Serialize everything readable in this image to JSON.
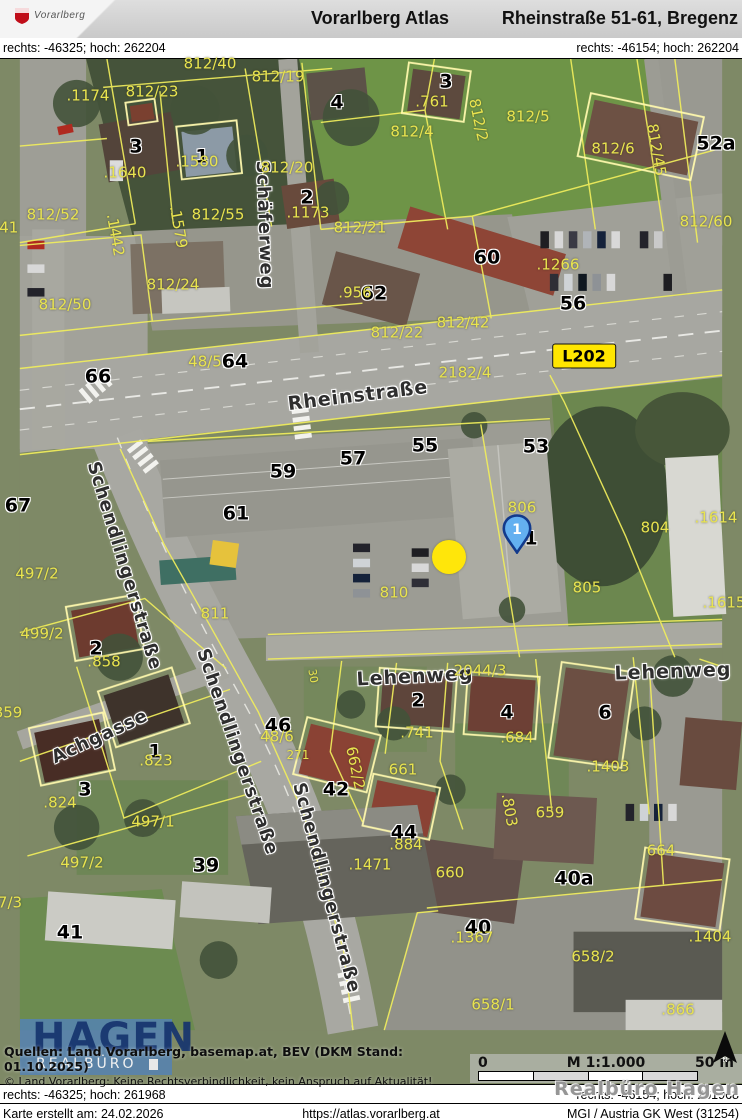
{
  "header": {
    "logo_text": "Vorarlberg",
    "app_title": "Vorarlberg Atlas",
    "page_title": "Rheinstraße 51-61, Bregenz"
  },
  "coords": {
    "top_left": "rechts: -46325; hoch: 262204",
    "top_right": "rechts: -46154; hoch: 262204",
    "bottom_left": "rechts: -46325; hoch: 261968",
    "bottom_right": "rechts: -46154; hoch: 261968"
  },
  "footer": {
    "created": "Karte erstellt am: 24.02.2026",
    "url": "https://atlas.vorarlberg.at",
    "crs": "MGI / Austria GK West (31254)"
  },
  "sources": {
    "line1": "Quellen: Land Vorarlberg, basemap.at, BEV (DKM Stand: 01.10.2025)",
    "line2": "© Land Vorarlberg: Keine Rechtsverbindlichkeit, kein Anspruch auf Aktualität!"
  },
  "scalebar": {
    "left": "0",
    "center": "M 1:1.000",
    "right": "50 m"
  },
  "watermark": "Realbüro Hagen",
  "logo_overlay": {
    "line1": "HAGEN",
    "line2": "REALBÜRO"
  },
  "markers": {
    "pin": {
      "x": 517,
      "y": 548,
      "label": "1"
    },
    "dot": {
      "x": 449,
      "y": 557
    },
    "road_badge": {
      "x": 584,
      "y": 356,
      "label": "L202"
    }
  },
  "colors": {
    "badge_bg": "#ffe600",
    "pin_fill": "#64b0f0",
    "pin_border": "#123a8c",
    "dot_fill": "#ffe60a",
    "parcel_text": "#e9e44f",
    "cadastral_line": "#f1ee5c",
    "logo_blue": "rgba(82,130,184,0.8)"
  },
  "map_labels": {
    "streets": [
      {
        "t": "Schäferweg",
        "x": 264,
        "y": 225,
        "r": 88
      },
      {
        "t": "Rheinstraße",
        "x": 358,
        "y": 396,
        "r": -7,
        "s": 19
      },
      {
        "t": "Schendlingerstraße",
        "x": 124,
        "y": 566,
        "r": 73
      },
      {
        "t": "Schendlingerstraße",
        "x": 237,
        "y": 752,
        "r": 71
      },
      {
        "t": "Schendlingerstraße",
        "x": 326,
        "y": 888,
        "r": 75
      },
      {
        "t": "Achgasse",
        "x": 100,
        "y": 737,
        "r": -25
      },
      {
        "t": "Lehenweg",
        "x": 415,
        "y": 677,
        "r": -3,
        "s": 19
      },
      {
        "t": "Lehenweg",
        "x": 673,
        "y": 672,
        "r": -2,
        "s": 19
      }
    ],
    "houses": [
      {
        "t": "4",
        "x": 337,
        "y": 103
      },
      {
        "t": "3",
        "x": 136,
        "y": 147
      },
      {
        "t": "1",
        "x": 202,
        "y": 157
      },
      {
        "t": "2",
        "x": 307,
        "y": 198
      },
      {
        "t": "3",
        "x": 446,
        "y": 82
      },
      {
        "t": "52a",
        "x": 716,
        "y": 144
      },
      {
        "t": "64",
        "x": 235,
        "y": 362
      },
      {
        "t": "66",
        "x": 98,
        "y": 377
      },
      {
        "t": "60",
        "x": 487,
        "y": 258
      },
      {
        "t": "62",
        "x": 374,
        "y": 294
      },
      {
        "t": "56",
        "x": 573,
        "y": 304
      },
      {
        "t": "67",
        "x": 18,
        "y": 506
      },
      {
        "t": "59",
        "x": 283,
        "y": 472
      },
      {
        "t": "57",
        "x": 353,
        "y": 459
      },
      {
        "t": "55",
        "x": 425,
        "y": 446
      },
      {
        "t": "53",
        "x": 536,
        "y": 447
      },
      {
        "t": "61",
        "x": 236,
        "y": 514
      },
      {
        "t": "1",
        "x": 531,
        "y": 539
      },
      {
        "t": "46",
        "x": 278,
        "y": 726
      },
      {
        "t": "2",
        "x": 418,
        "y": 701
      },
      {
        "t": "4",
        "x": 507,
        "y": 713
      },
      {
        "t": "6",
        "x": 605,
        "y": 713
      },
      {
        "t": "42",
        "x": 336,
        "y": 790
      },
      {
        "t": "44",
        "x": 404,
        "y": 833
      },
      {
        "t": "1",
        "x": 155,
        "y": 752
      },
      {
        "t": "3",
        "x": 85,
        "y": 790
      },
      {
        "t": "39",
        "x": 206,
        "y": 866
      },
      {
        "t": "41",
        "x": 70,
        "y": 933
      },
      {
        "t": "40",
        "x": 478,
        "y": 928
      },
      {
        "t": "40a",
        "x": 574,
        "y": 879
      },
      {
        "t": "2",
        "x": 96,
        "y": 649
      }
    ],
    "parcels": [
      {
        "t": "812/40",
        "x": 210,
        "y": 64
      },
      {
        "t": ".1174",
        "x": 88,
        "y": 96
      },
      {
        "t": "812/23",
        "x": 152,
        "y": 92
      },
      {
        "t": "812/19",
        "x": 278,
        "y": 77
      },
      {
        "t": ".761",
        "x": 432,
        "y": 102
      },
      {
        "t": "812/4",
        "x": 412,
        "y": 132
      },
      {
        "t": "812/2",
        "x": 478,
        "y": 120,
        "r": 78
      },
      {
        "t": "812/5",
        "x": 528,
        "y": 117
      },
      {
        "t": "812/6",
        "x": 613,
        "y": 149
      },
      {
        "t": "812/45",
        "x": 656,
        "y": 150,
        "r": 80
      },
      {
        "t": "812/60",
        "x": 706,
        "y": 222
      },
      {
        "t": ".1640",
        "x": 125,
        "y": 173
      },
      {
        "t": ".1580",
        "x": 197,
        "y": 162
      },
      {
        "t": "812/20",
        "x": 287,
        "y": 168
      },
      {
        "t": ".1173",
        "x": 308,
        "y": 213
      },
      {
        "t": "812/52",
        "x": 53,
        "y": 215
      },
      {
        "t": ".1442",
        "x": 115,
        "y": 235,
        "r": 80
      },
      {
        "t": ".1579",
        "x": 178,
        "y": 227,
        "r": 80
      },
      {
        "t": "812/55",
        "x": 218,
        "y": 215
      },
      {
        "t": "441",
        "x": 4,
        "y": 228
      },
      {
        "t": "812/50",
        "x": 65,
        "y": 305
      },
      {
        "t": "812/24",
        "x": 173,
        "y": 285
      },
      {
        "t": "812/21",
        "x": 360,
        "y": 228
      },
      {
        "t": ".956",
        "x": 355,
        "y": 293
      },
      {
        "t": ".1266",
        "x": 558,
        "y": 265
      },
      {
        "t": "812/42",
        "x": 463,
        "y": 323
      },
      {
        "t": "812/22",
        "x": 397,
        "y": 333
      },
      {
        "t": "48/5",
        "x": 205,
        "y": 362
      },
      {
        "t": "2182/4",
        "x": 465,
        "y": 373
      },
      {
        "t": "2044/3",
        "x": 480,
        "y": 671
      },
      {
        "t": "806",
        "x": 522,
        "y": 508
      },
      {
        "t": "805",
        "x": 587,
        "y": 588
      },
      {
        "t": "804",
        "x": 655,
        "y": 528
      },
      {
        "t": ".1614",
        "x": 716,
        "y": 518
      },
      {
        "t": ".1615",
        "x": 724,
        "y": 603
      },
      {
        "t": "810",
        "x": 394,
        "y": 593
      },
      {
        "t": "811",
        "x": 215,
        "y": 614
      },
      {
        "t": "497/2",
        "x": 37,
        "y": 574
      },
      {
        "t": "499/2",
        "x": 42,
        "y": 634
      },
      {
        "t": ".858",
        "x": 104,
        "y": 662
      },
      {
        "t": "859",
        "x": 8,
        "y": 713
      },
      {
        "t": ".824",
        "x": 60,
        "y": 803
      },
      {
        "t": ".823",
        "x": 156,
        "y": 761
      },
      {
        "t": "497/1",
        "x": 153,
        "y": 822
      },
      {
        "t": "497/2",
        "x": 82,
        "y": 863
      },
      {
        "t": "7/3",
        "x": 10,
        "y": 903
      },
      {
        "t": "48/6",
        "x": 277,
        "y": 737
      },
      {
        "t": "271",
        "x": 298,
        "y": 755,
        "s": 12
      },
      {
        "t": "662/2",
        "x": 355,
        "y": 768,
        "r": 78
      },
      {
        "t": ".741",
        "x": 417,
        "y": 733
      },
      {
        "t": "661",
        "x": 403,
        "y": 770
      },
      {
        "t": ".684",
        "x": 517,
        "y": 738
      },
      {
        "t": ".1403",
        "x": 608,
        "y": 767
      },
      {
        "t": "659",
        "x": 550,
        "y": 813
      },
      {
        "t": ".803",
        "x": 509,
        "y": 810,
        "r": 80
      },
      {
        "t": "664",
        "x": 661,
        "y": 851
      },
      {
        "t": ".884",
        "x": 406,
        "y": 845
      },
      {
        "t": ".1471",
        "x": 370,
        "y": 865
      },
      {
        "t": "660",
        "x": 450,
        "y": 873
      },
      {
        "t": "658/2",
        "x": 593,
        "y": 957
      },
      {
        "t": "658/1",
        "x": 493,
        "y": 1005
      },
      {
        "t": ".1367",
        "x": 472,
        "y": 938
      },
      {
        "t": ".1404",
        "x": 710,
        "y": 937
      },
      {
        "t": ".866",
        "x": 678,
        "y": 1010
      },
      {
        "t": "30",
        "x": 313,
        "y": 676,
        "r": 80,
        "s": 11
      }
    ]
  }
}
